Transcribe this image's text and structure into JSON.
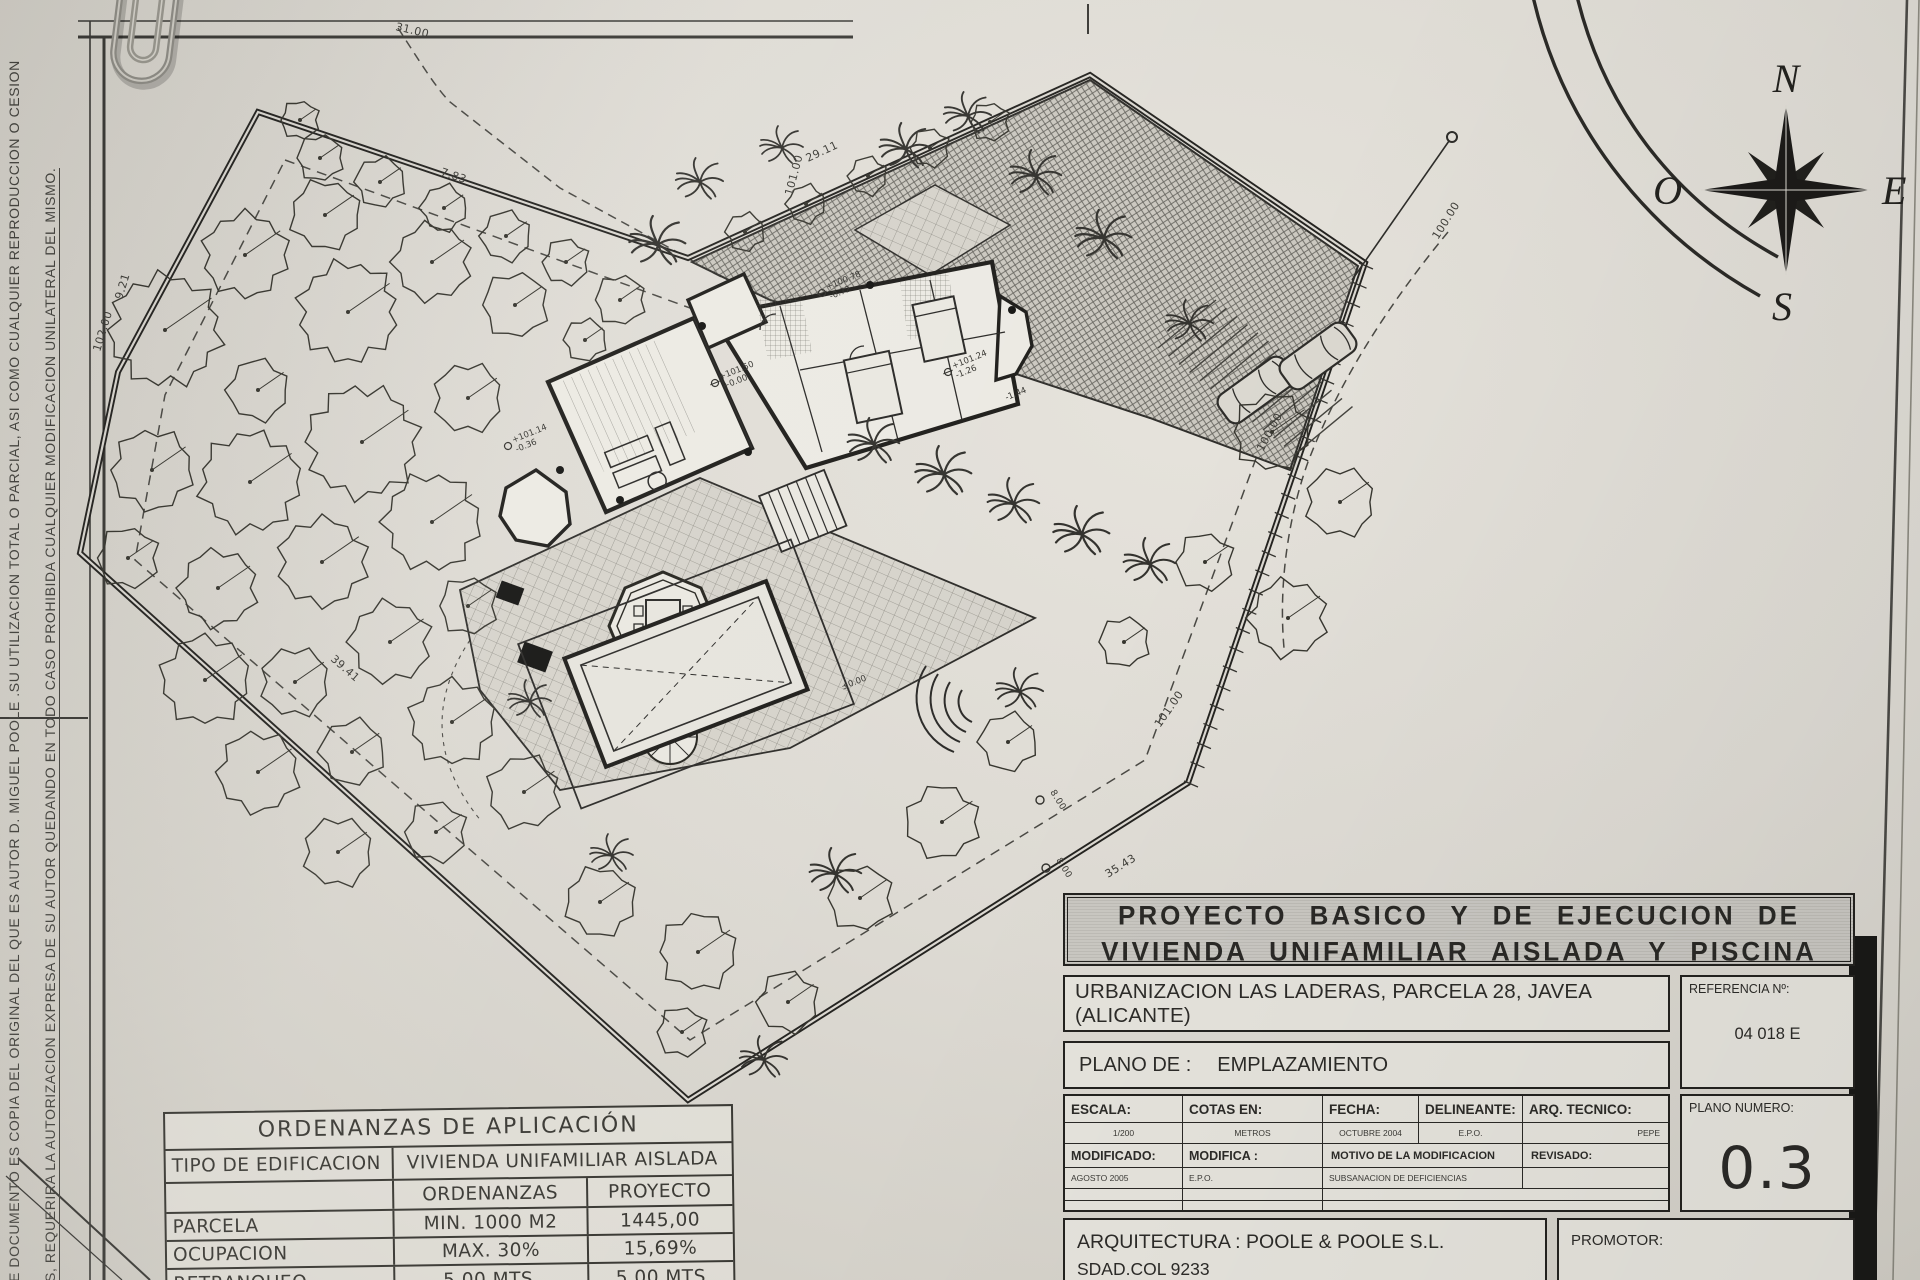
{
  "side_note": {
    "line1": "E DOCUMENTO ES COPIA DEL ORIGINAL DEL QUE ES AUTOR D. MIGUEL POOLE .SU UTILIZACION TOTAL O PARCIAL, ASI COMO CUALQUIER REPRODUCCION O CESION",
    "line2": "S, REQUERIRA LA AUTORIZACION EXPRESA DE SU AUTOR QUEDANDO EN TODO CASO PROHIBIDA CUALQUIER MODIFICACION UNILATERAL DEL MISMO."
  },
  "compass": {
    "north": "N",
    "south": "S",
    "east": "E",
    "west": "O"
  },
  "title_block": {
    "title_line1": "PROYECTO BASICO Y DE EJECUCION DE",
    "title_line2": "VIVIENDA UNIFAMILIAR AISLADA Y PISCINA",
    "address": "URBANIZACION LAS LADERAS, PARCELA 28, JAVEA (ALICANTE)",
    "referencia_label": "REFERENCIA Nº:",
    "referencia_value": "04 018 E",
    "plano_de_label": "PLANO DE :",
    "plano_de_value": "EMPLAZAMIENTO",
    "grid": {
      "escala_label": "ESCALA:",
      "escala_value": "1/200",
      "cotas_label": "COTAS EN:",
      "cotas_value": "METROS",
      "fecha_label": "FECHA:",
      "fecha_value": "OCTUBRE 2004",
      "delineante_label": "DELINEANTE:",
      "delineante_value": "E.P.O.",
      "arq_label": "ARQ. TECNICO:",
      "arq_value": "PEPE",
      "modificado_label": "MODIFICADO:",
      "modificado_value": "AGOSTO 2005",
      "modifica_label": "MODIFICA :",
      "modifica_value": "E.P.O.",
      "motivo_label": "MOTIVO DE LA MODIFICACION",
      "motivo_value": "SUBSANACION DE DEFICIENCIAS",
      "revisado_label": "REVISADO:"
    },
    "plano_numero_label": "PLANO NUMERO:",
    "plano_numero_value": "0.3",
    "arquitectura_line1": "ARQUITECTURA : POOLE & POOLE S.L.",
    "arquitectura_line2": "SDAD.COL 9233",
    "promotor_label": "PROMOTOR:"
  },
  "ordenanzas_table": {
    "title": "ORDENANZAS DE APLICACIÓN",
    "tipo_label": "TIPO DE EDIFICACION",
    "tipo_value": "VIVIENDA UNIFAMILIAR AISLADA",
    "col_ordenanzas": "ORDENANZAS",
    "col_proyecto": "PROYECTO",
    "rows": [
      {
        "name": "PARCELA",
        "ordenanza": "MIN. 1000 M2",
        "proyecto": "1445,00"
      },
      {
        "name": "OCUPACION",
        "ordenanza": "MAX. 30%",
        "proyecto": "15,69%"
      },
      {
        "name": "RETRANQUEO",
        "ordenanza": "5,00 MTS.",
        "proyecto": "5,00 MTS"
      }
    ]
  },
  "plan": {
    "dims": {
      "d31": "31.00",
      "d783": "7.83",
      "d101t": "101.00",
      "d2911": "29.11",
      "d921": "9.21",
      "d102": "102.00",
      "d3941": "39.41",
      "d3543": "35.43",
      "d101r": "101.00",
      "d800a": "8.00",
      "d800b": "8.00"
    },
    "contours": {
      "c100a": "100.00",
      "c100b": "100.00"
    },
    "levels": [
      {
        "a": "+100.78",
        "b": "-0.72"
      },
      {
        "a": "+101.50",
        "b": "+0.00"
      },
      {
        "a": "+101.24",
        "b": "-1.26"
      },
      {
        "a": "-1.44",
        "b": ""
      },
      {
        "a": "+101.14",
        "b": "-0.36"
      },
      {
        "a": "±0.00",
        "b": ""
      }
    ]
  }
}
